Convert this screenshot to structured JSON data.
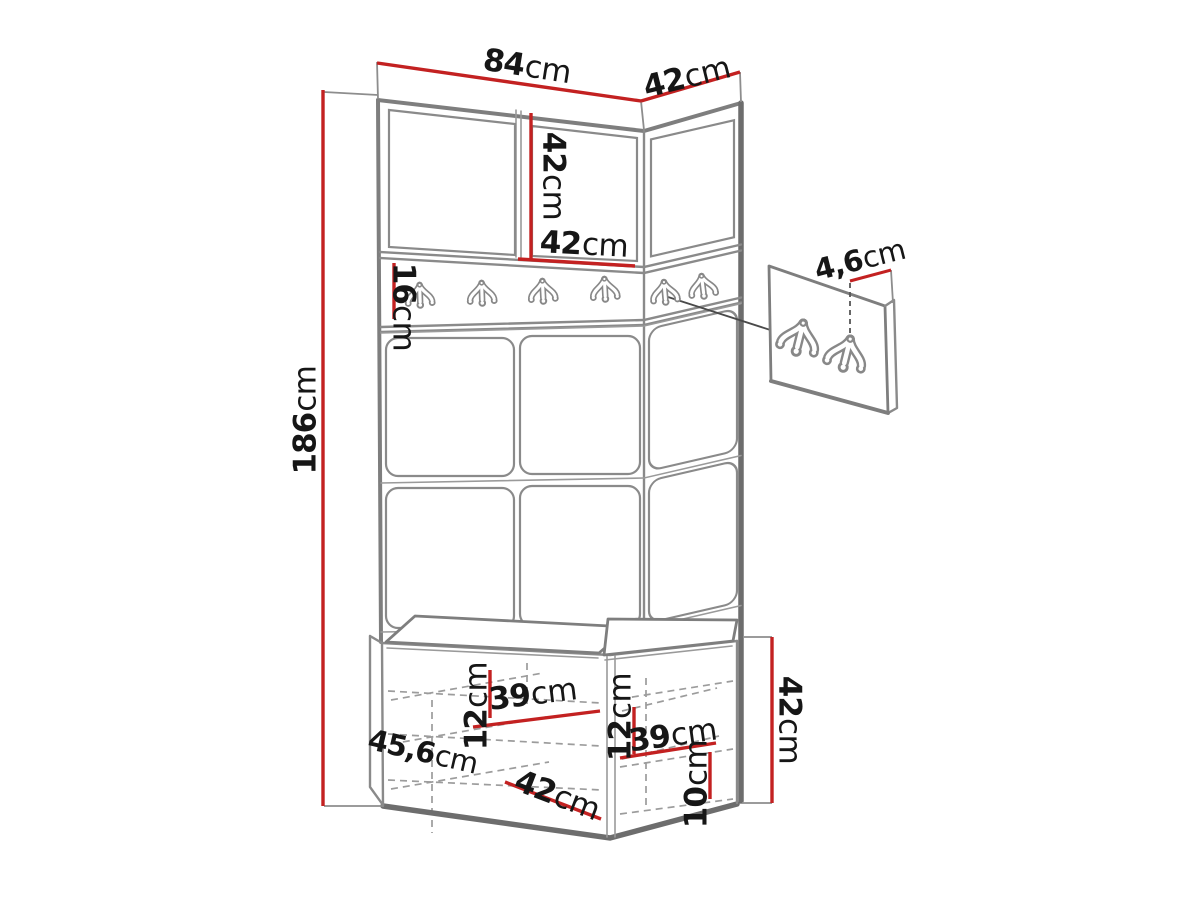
{
  "diagram": {
    "kind": "furniture dimension drawing",
    "subject": "hallway wardrobe set with coat hooks, upholstered panels and shoe bench",
    "hooks": {
      "main_row_count": 6,
      "detail_panel_count": 2
    },
    "colors": {
      "dimension_red": "#c32121",
      "outline_gray": "#828282",
      "text": "#161616",
      "background": "#ffffff"
    }
  },
  "dims": {
    "width_front": {
      "value": "84",
      "unit": "cm"
    },
    "width_side": {
      "value": "42",
      "unit": "cm"
    },
    "door_height": {
      "value": "42",
      "unit": "cm"
    },
    "door_width": {
      "value": "42",
      "unit": "cm"
    },
    "hook_rail_height": {
      "value": "16",
      "unit": "cm"
    },
    "total_height": {
      "value": "186",
      "unit": "cm"
    },
    "hook_panel_depth": {
      "value": "4,6",
      "unit": "cm"
    },
    "bench_total_depth": {
      "value": "45,6",
      "unit": "cm"
    },
    "shelf_gap_left": {
      "value": "12",
      "unit": "cm"
    },
    "shelf_width_left": {
      "value": "39",
      "unit": "cm"
    },
    "shelf_gap_right": {
      "value": "12",
      "unit": "cm"
    },
    "shelf_width_right": {
      "value": "39",
      "unit": "cm"
    },
    "bottom_gap": {
      "value": "10",
      "unit": "cm"
    },
    "bench_depth": {
      "value": "42",
      "unit": "cm"
    },
    "bench_height": {
      "value": "42",
      "unit": "cm"
    }
  }
}
